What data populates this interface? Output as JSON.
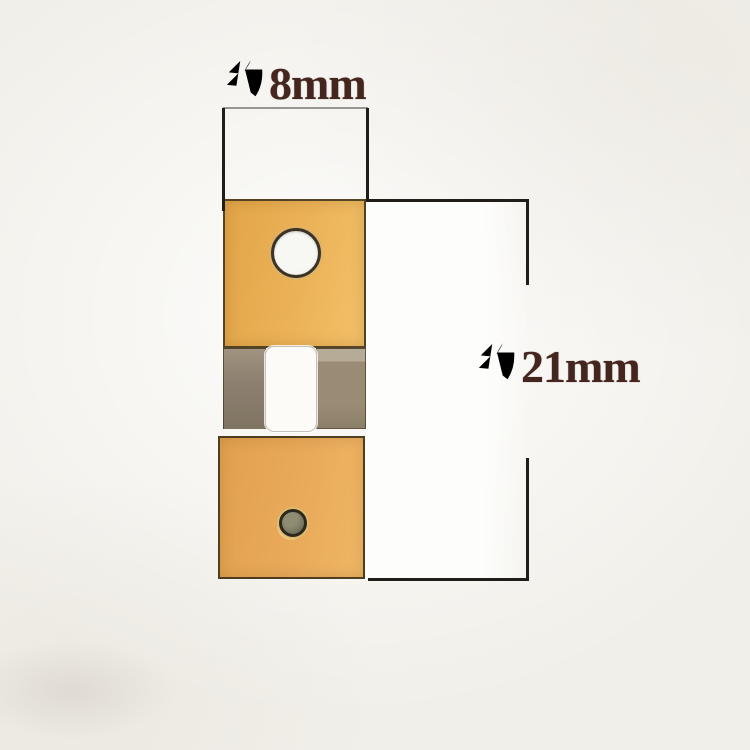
{
  "annotations": {
    "width": {
      "label": "约8mm",
      "prefix": "约",
      "value_text": "8mm",
      "text_color": "#45261f",
      "line_color": "#211e19"
    },
    "height": {
      "label": "约21mm",
      "prefix": "约",
      "value_text": "21mm",
      "text_color": "#45261f",
      "line_color": "#211e19"
    }
  },
  "photo": {
    "background_color": "#f1efe9",
    "backdrop_strip_color": "#fdfdfb",
    "part": {
      "top_plate_color": "#ecb258",
      "bottom_plate_color": "#e9aa5a",
      "spring_strip_left_color": "#8d8070",
      "spring_strip_right_color": "#9a8c74",
      "slot_color": "#fcfbf8",
      "hole_color": "#f7f7f4",
      "pin_color": "#75725c",
      "edge_color": "#3a3021"
    }
  }
}
